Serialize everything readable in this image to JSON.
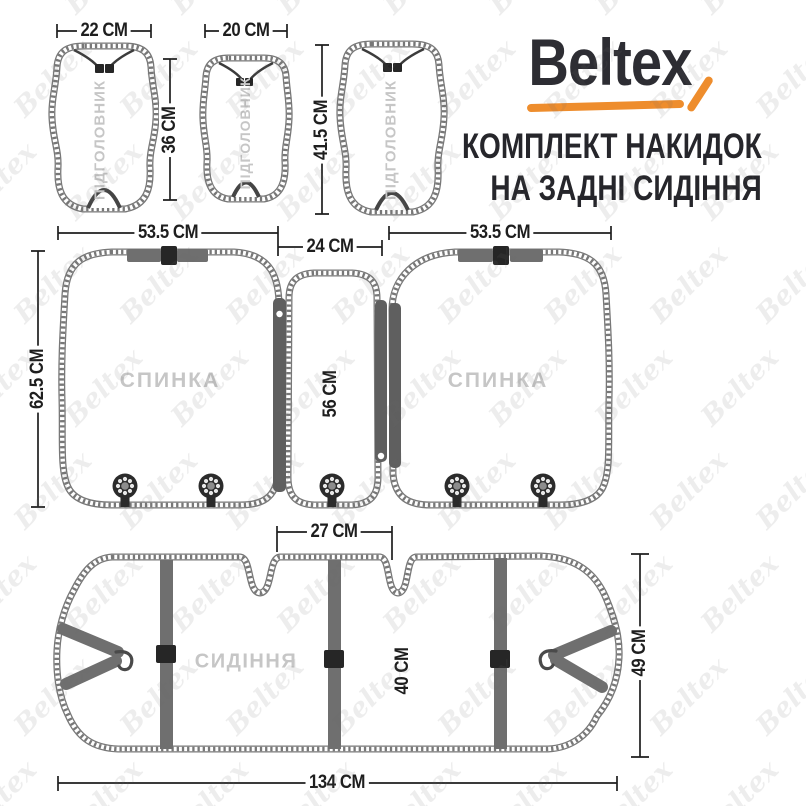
{
  "header": {
    "brand": "Beltex",
    "title_line1": "КОМПЛЕКТ НАКИДОК",
    "title_line2": "НА ЗАДНІ СИДІННЯ"
  },
  "piece_labels": {
    "headrest": "ПІДГОЛОВНИК",
    "backrest": "СПИНКА",
    "seat": "СИДІННЯ"
  },
  "dimensions": {
    "headrest_large_width": "22 CM",
    "headrest_small_width": "20 CM",
    "headrest_small_height": "36 CM",
    "headrest_large_height": "41.5 CM",
    "backrest_left_width": "53.5 CM",
    "backrest_center_width": "24 CM",
    "backrest_right_width": "53.5 CM",
    "backrest_height": "62.5 CM",
    "backrest_center_height": "56 CM",
    "seat_hump_gap": "27 CM",
    "seat_depth": "40 CM",
    "seat_side_height": "49 CM",
    "seat_width": "134 CM"
  },
  "watermark": {
    "text": "Beltex"
  },
  "colors": {
    "accent-orange": "#EE8D2D",
    "logo-ink": "#2D2D33",
    "ink": "#1E1E1E",
    "muted-label": "#C6C6C6",
    "stitch": "#787878",
    "strap": "#6F6F6F",
    "hardware": "#262626"
  }
}
